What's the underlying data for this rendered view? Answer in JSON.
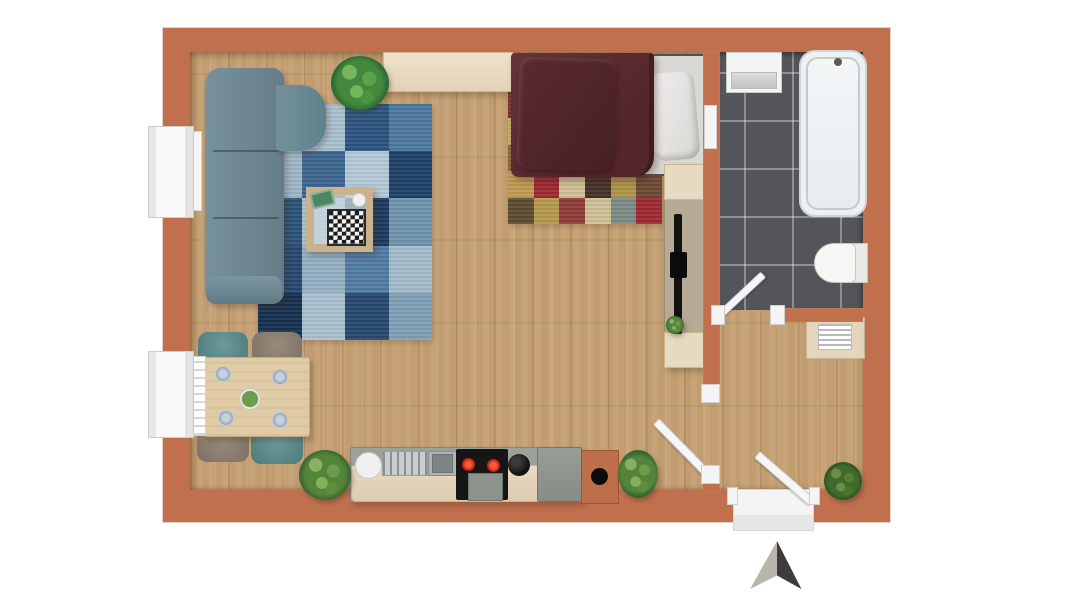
{
  "scene": {
    "kind": "apartment-floor-plan-top-view",
    "rooms": [
      {
        "name": "living-dining-kitchen",
        "furniture": [
          "corner-sofa",
          "patchwork-rug-blue",
          "coffee-table",
          "chess-board",
          "sideboard",
          "potted-plant",
          "double-bed",
          "patchwork-rug-multicolor",
          "tv-lowboard",
          "wall-tv",
          "dining-table",
          "dining-chairs",
          "kitchen-counter",
          "kitchen-sink",
          "cooktop",
          "oven",
          "kettle",
          "fridge",
          "chimney-block"
        ]
      },
      {
        "name": "bathroom",
        "furniture": [
          "washbasin",
          "bathtub",
          "toilet",
          "towel-radiator"
        ]
      },
      {
        "name": "hallway",
        "furniture": [
          "wall-shelf",
          "potted-plant"
        ]
      }
    ],
    "openings": [
      "window-left-top",
      "window-left-bottom",
      "bathroom-door",
      "room-hall-door",
      "entrance-door"
    ],
    "compass": {
      "direction": "north",
      "style": "two-tone-arrow"
    }
  },
  "palette": {
    "background": "#ffffff",
    "wall": "#c1704e",
    "wood_floor": "#c7a478",
    "tile_floor": "#53555a",
    "sofa": "#6f8791",
    "bed_duvet": "#5c2b30",
    "mattress": "#d9d8d4",
    "table_wood": "#dfcba6",
    "chair_teal": "#5f8a8b",
    "chair_gray": "#8d8173",
    "counter": "#9ba19b",
    "cabinet_beige": "#e4d4bc",
    "cooktop": "#161616",
    "burner_red": "#c3271a",
    "fridge": "#90958f",
    "tv_cabinet": "#b7aa95",
    "glass": "#cdd8dd",
    "plant_green": "#4e7d3a",
    "arrow_light": "#b9b5ad",
    "arrow_dark": "#3d3d3f",
    "door_white": "#f4f4f4"
  },
  "rugs": {
    "living": {
      "cols": 4,
      "rows": 5,
      "patches": [
        [
          "#7293ab",
          "#a9c0cf",
          "#2c5480",
          "#4e79a2"
        ],
        [
          "#9db6c6",
          "#3c6690",
          "#b3c8d6",
          "#1e4168"
        ],
        [
          "#2b5277",
          "#a9c0cf",
          "#1b3a5f",
          "#6f93ad"
        ],
        [
          "#27496f",
          "#93b0c4",
          "#527ba4",
          "#a3bccb"
        ],
        [
          "#16304f",
          "#a9c0cf",
          "#27496f",
          "#7f9fb6"
        ]
      ]
    },
    "bedroom": {
      "cols": 6,
      "rows": 5,
      "patches": [
        [
          "#7a3434",
          "#8a3a2e",
          "#c09a52",
          "#6b2d2d",
          "#9e2832",
          "#5a2a2e"
        ],
        [
          "#c7ad6a",
          "#5a2a2e",
          "#9aa8a4",
          "#c09a52",
          "#463028",
          "#b5433b"
        ],
        [
          "#8a6a3a",
          "#cfc094",
          "#7a3030",
          "#ac9348",
          "#9e2832",
          "#cfc094"
        ],
        [
          "#c09a52",
          "#9e2832",
          "#cfc094",
          "#463028",
          "#ac9348",
          "#6b4a32"
        ],
        [
          "#5e4a30",
          "#b59a4f",
          "#8f3a3a",
          "#cfc094",
          "#7d8a84",
          "#9e2832"
        ]
      ]
    }
  }
}
